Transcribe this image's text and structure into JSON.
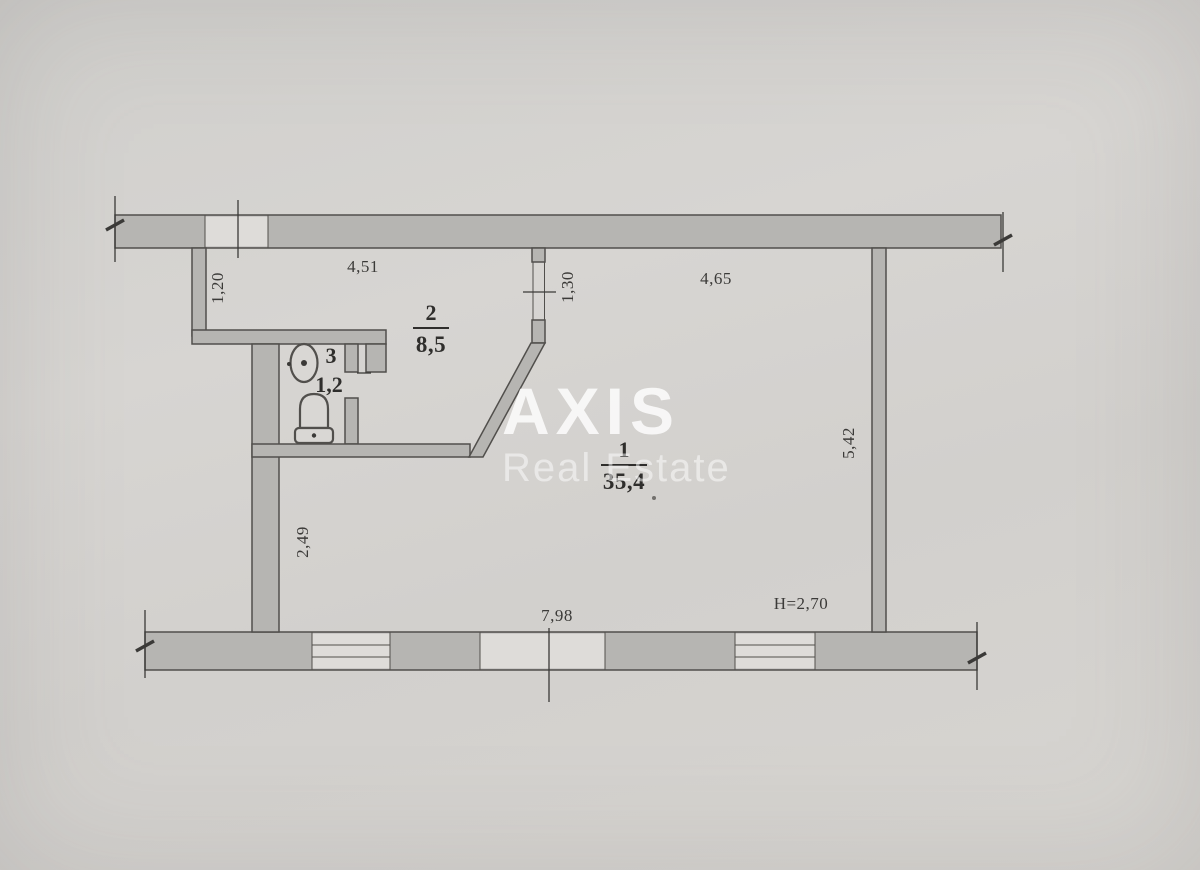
{
  "watermark": {
    "brand": "AXIS",
    "tagline": "Real Estate"
  },
  "rooms": {
    "room1": {
      "number": "1",
      "area": "35,4"
    },
    "room2": {
      "number": "2",
      "area": "8,5"
    },
    "room3": {
      "number": "3",
      "area": "1,2"
    }
  },
  "dimensions": {
    "top_left_width": "4,51",
    "top_right_width": "4,65",
    "left_upper_wall": "1,20",
    "middle_doorway": "1,30",
    "right_room_depth": "5,42",
    "left_lower_wall": "2,49",
    "bottom_total_width": "7,98",
    "ceiling_height": "H=2,70"
  },
  "icons": {
    "sink": "sink-icon",
    "toilet": "toilet-icon"
  },
  "colors": {
    "bg": "#d4d2cf",
    "wall": "#b6b5b2",
    "line": "#514f4c",
    "dim": "#3b3a38",
    "ink": "#2f2e2c",
    "fixture": "#d9d7d4",
    "watermark": "#ffffff"
  }
}
